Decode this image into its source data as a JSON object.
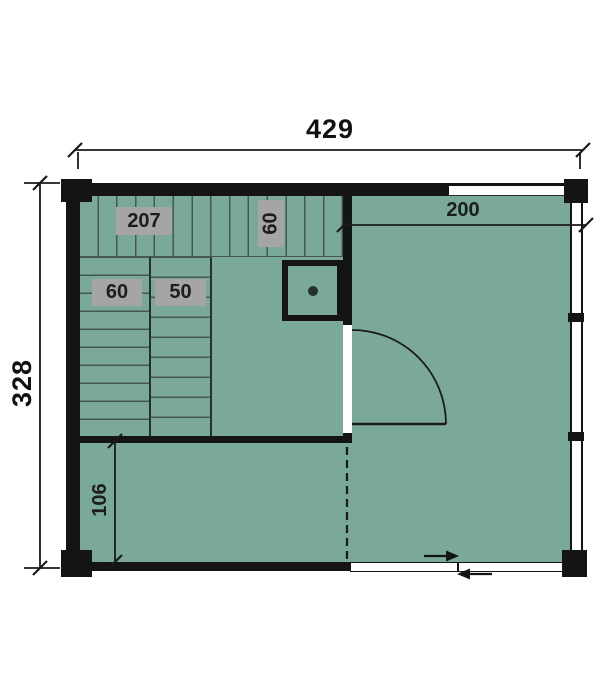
{
  "plan": {
    "kind": "sauna-cabin-floor-plan",
    "dimensions": {
      "overall_width": "429",
      "overall_height": "328",
      "right_room_width": "200",
      "lower_room_depth": "106"
    },
    "sauna_room": {
      "top_bench_length": "207",
      "top_bench_depth": "60",
      "left_bench_width": "60",
      "right_bench_width": "50"
    }
  },
  "colors": {
    "floor_green": "#7aa89b",
    "wall_black": "#141414",
    "slat_line": "#44584f",
    "tag_gray": "#a5a5a5",
    "dim_line": "#1a1a1a",
    "background": "#ffffff"
  }
}
